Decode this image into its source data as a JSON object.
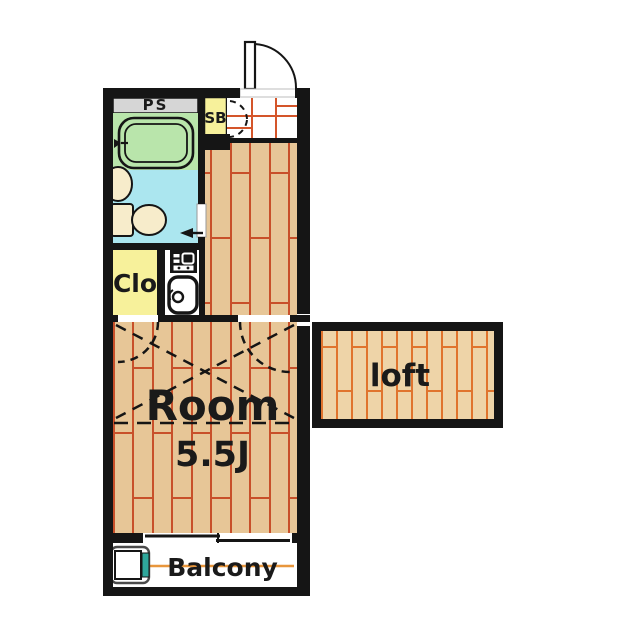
{
  "floorplan": {
    "title": "1-room apartment floor plan with loft",
    "labels": {
      "pipe_space": "PS",
      "shoe_box": "SB",
      "closet": "Clo",
      "room_name": "Room",
      "room_size": "5.5J",
      "loft": "loft",
      "balcony": "Balcony"
    },
    "rooms": [
      {
        "name": "bathroom",
        "fixture": "bathtub"
      },
      {
        "name": "toilet-room",
        "fixtures": [
          "toilet",
          "washbasin"
        ]
      },
      {
        "name": "kitchen",
        "fixtures": [
          "gas-stove",
          "sink"
        ]
      },
      {
        "name": "entrance",
        "fixture": "shoe-box"
      },
      {
        "name": "main-room",
        "size_label": "5.5J"
      },
      {
        "name": "loft"
      },
      {
        "name": "balcony",
        "fixture": "washing-machine-pan"
      }
    ],
    "colors": {
      "wall": "#151515",
      "pipe_space": "#d6d6d6",
      "bathroom": "#b9e5ab",
      "toilet_room": "#abe6ef",
      "closet": "#f7f19b",
      "shoe_box": "#f7f19b",
      "kitchen": "#ffffff",
      "entrance_tile": "#ffffff",
      "tile_grid": "#d4552a",
      "flooring": "#e7c697",
      "flooring_lines": "#c8502a",
      "loft_flooring": "#eed4a8",
      "loft_lines": "#e0742e",
      "fixture_cream": "#f7eccb",
      "balcony_line": "#e8963c",
      "washer_tap": "#2fa79b",
      "white": "#ffffff"
    }
  }
}
